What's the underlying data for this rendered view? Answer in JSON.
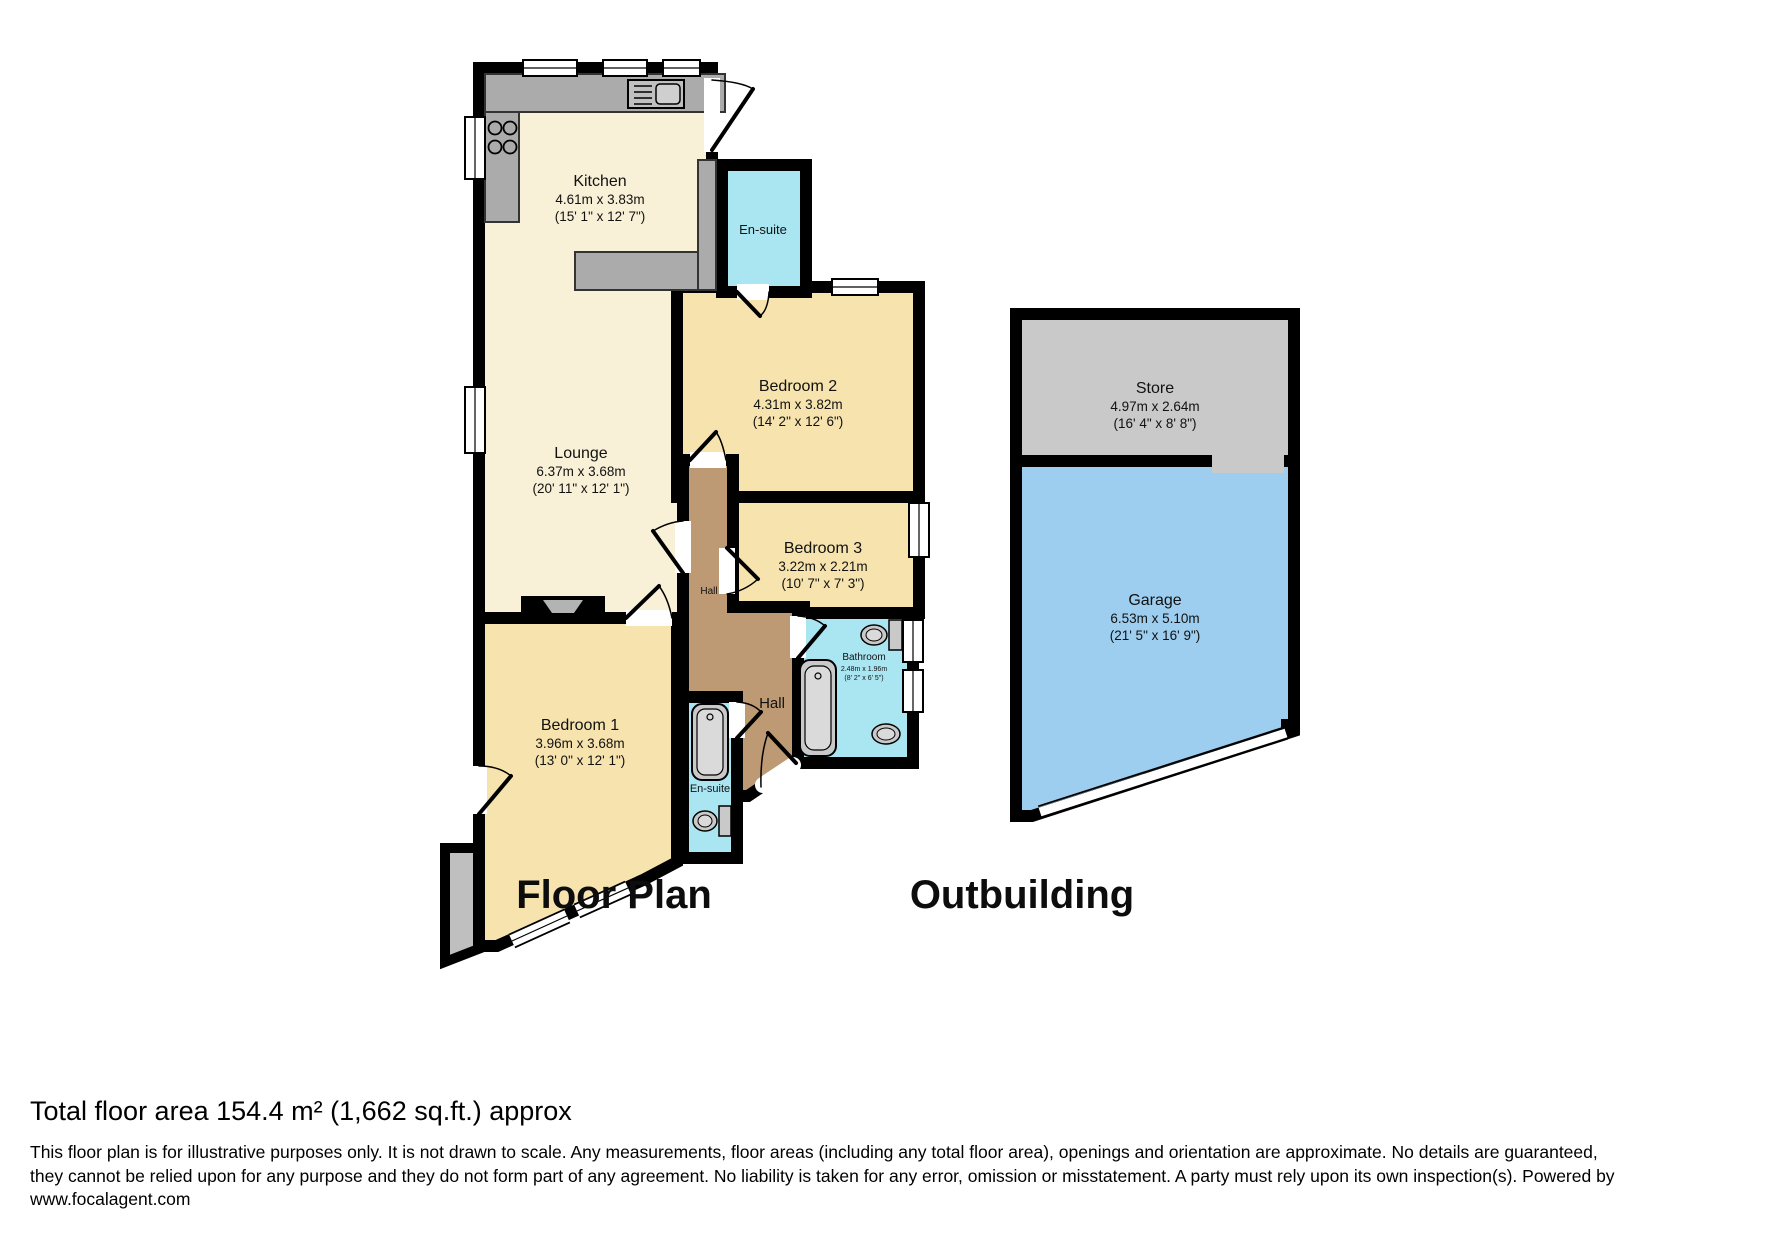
{
  "floor_plan": {
    "title": "Floor Plan",
    "rooms": {
      "kitchen": {
        "name": "Kitchen",
        "metric": "4.61m x 3.83m",
        "imperial": "(15' 1\" x 12' 7\")"
      },
      "lounge": {
        "name": "Lounge",
        "metric": "6.37m x 3.68m",
        "imperial": "(20' 11\" x 12' 1\")"
      },
      "bedroom1": {
        "name": "Bedroom 1",
        "metric": "3.96m x 3.68m",
        "imperial": "(13' 0\" x 12' 1\")"
      },
      "bedroom2": {
        "name": "Bedroom 2",
        "metric": "4.31m x 3.82m",
        "imperial": "(14' 2\" x 12' 6\")"
      },
      "bedroom3": {
        "name": "Bedroom 3",
        "metric": "3.22m x 2.21m",
        "imperial": "(10' 7\" x 7' 3\")"
      },
      "bathroom": {
        "name": "Bathroom",
        "metric": "2.48m x 1.96m",
        "imperial": "(8' 2\" x 6' 5\")"
      },
      "ensuite_top": {
        "name": "En-suite"
      },
      "ensuite_bottom": {
        "name": "En-suite"
      },
      "hall_upper": {
        "name": "Hall"
      },
      "hall_lower": {
        "name": "Hall"
      }
    }
  },
  "outbuilding": {
    "title": "Outbuilding",
    "rooms": {
      "store": {
        "name": "Store",
        "metric": "4.97m x 2.64m",
        "imperial": "(16' 4\" x 8' 8\")"
      },
      "garage": {
        "name": "Garage",
        "metric": "6.53m x 5.10m",
        "imperial": "(21' 5\" x 16' 9\")"
      }
    }
  },
  "footer": {
    "total_area": "Total floor area 154.4 m² (1,662 sq.ft.) approx",
    "disclaimer_lines": [
      "This floor plan is for illustrative purposes only. It is not drawn to scale. Any measurements, floor areas (including any total floor area), openings and orientation are approximate. No details are guaranteed,",
      "they cannot be relied upon for any purpose and they do not form part of any agreement. No liability is taken for any error, omission or misstatement. A party must rely upon its own inspection(s). Powered by",
      "www.focalagent.com"
    ]
  },
  "colors": {
    "wall": "#000000",
    "cream_room": "#F8F1D7",
    "yellow_room": "#F6E3AE",
    "wet_room": "#A9E6F2",
    "hall": "#BD9A73",
    "counter": "#ABABAB",
    "fixture": "#C9C9C9",
    "store": "#C9C9C9",
    "garage": "#9DCEEF"
  }
}
